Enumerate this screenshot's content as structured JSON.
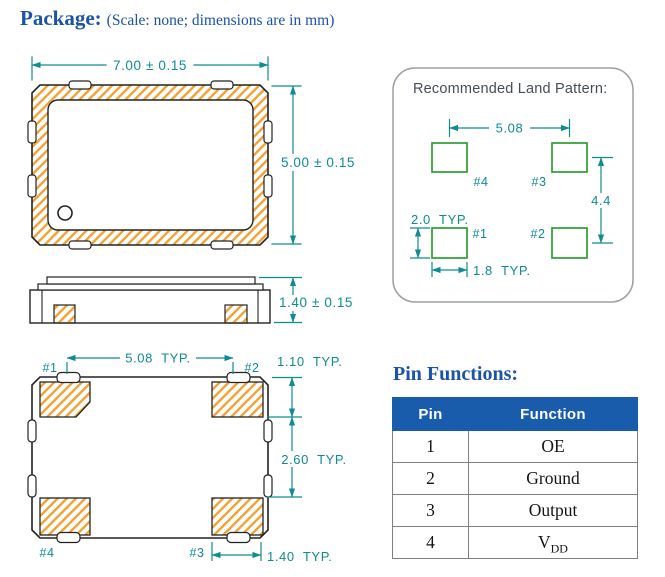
{
  "page": {
    "title": "Package:",
    "subtitle": "(Scale: none; dimensions are in mm)"
  },
  "colors": {
    "title_blue": "#1a53a8",
    "table_header_blue": "#1a5cac",
    "dimension_teal": "#0e8c8f",
    "hatch_orange": "#f0a235",
    "pad_green": "#2f9e32",
    "outline_black": "#222222",
    "panel_border_gray": "#9aa0a3",
    "table_border_gray": "#7f7f7f"
  },
  "top_view": {
    "dim_width": "7.00 ± 0.15",
    "dim_height": "5.00 ± 0.15"
  },
  "side_view": {
    "dim_height": "1.40 ± 0.15"
  },
  "bottom_view": {
    "dim_pad_spacing": "5.08  TYP.",
    "dim_pad_height": "1.10  TYP.",
    "dim_pad_gap": "2.60  TYP.",
    "dim_pad_width": "1.40  TYP.",
    "pads": {
      "p1": "#1",
      "p2": "#2",
      "p3": "#3",
      "p4": "#4"
    }
  },
  "land_pattern": {
    "title": "Recommended Land Pattern:",
    "dim_pad_spacing": "5.08",
    "dim_vertical": "4.4",
    "dim_pad_height": "2.0  TYP.",
    "dim_pad_width": "1.8  TYP.",
    "pads": {
      "p1": "#1",
      "p2": "#2",
      "p3": "#3",
      "p4": "#4"
    }
  },
  "pin_functions": {
    "title": "Pin Functions:",
    "headers": [
      "Pin",
      "Function"
    ],
    "rows": [
      {
        "pin": "1",
        "function": "OE"
      },
      {
        "pin": "2",
        "function": "Ground"
      },
      {
        "pin": "3",
        "function": "Output"
      },
      {
        "pin": "4",
        "function": "V",
        "function_sub": "DD"
      }
    ]
  }
}
